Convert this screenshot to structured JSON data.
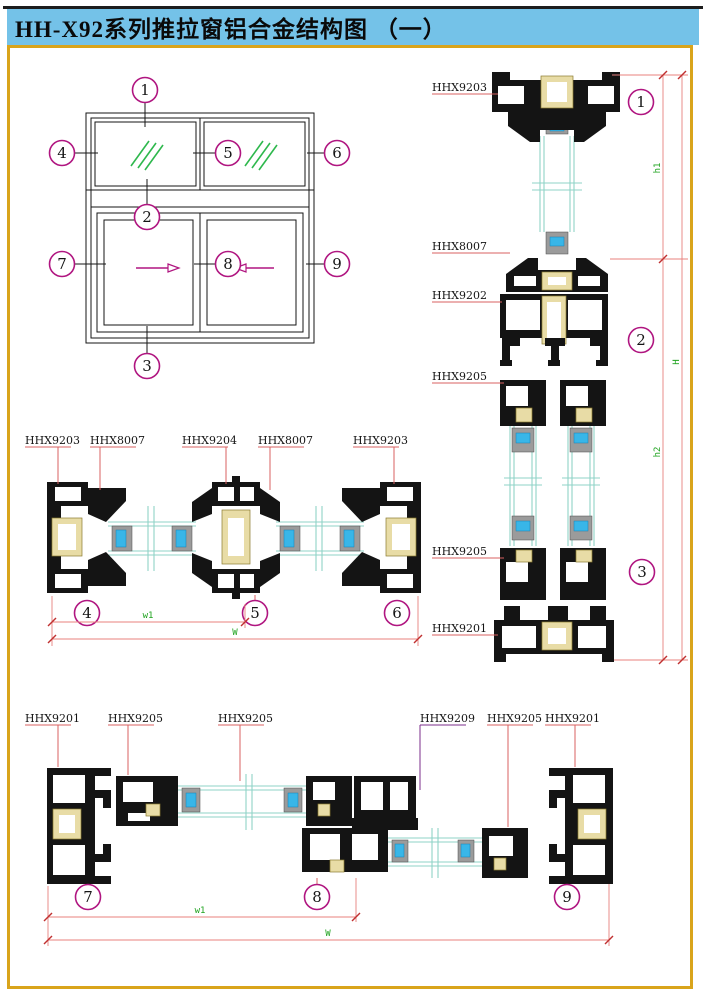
{
  "title": "HH-X92系列推拉窗铝合金结构图 （一）",
  "colors": {
    "title_bg": "#74c2e8",
    "border_gold": "#d9a41b",
    "callout_magenta": "#b01580",
    "leader_red": "#d96060",
    "leader_purple": "#7b2d8b",
    "dim_line_pink": "#e8807e",
    "dim_text_green": "#1fa31f",
    "glass_teal": "#8fd3c7",
    "hatch_green": "#2eb84d",
    "thermal_tan": "#e8dca6",
    "spacer_gray": "#9b9b9b",
    "glazing_blue": "#38b6e8",
    "profile_black": "#141414"
  },
  "schematic": {
    "callouts": [
      "1",
      "2",
      "3",
      "4",
      "5",
      "6",
      "7",
      "8",
      "9"
    ]
  },
  "vertical_section": {
    "labels": [
      "HHX9203",
      "HHX8007",
      "HHX9202",
      "HHX9205",
      "HHX9205",
      "HHX9201"
    ],
    "callouts": [
      "1",
      "2",
      "3"
    ],
    "dims": {
      "inner_top": "h1",
      "overall": "H",
      "inner_bottom": "h2"
    }
  },
  "top_horizontal_section": {
    "labels": [
      "HHX9203",
      "HHX8007",
      "HHX9204",
      "HHX8007",
      "HHX9203"
    ],
    "callouts": [
      "4",
      "5",
      "6"
    ],
    "dims": {
      "inner": "w1",
      "overall": "W"
    }
  },
  "bottom_horizontal_section": {
    "labels": [
      "HHX9201",
      "HHX9205",
      "HHX9205",
      "HHX9209",
      "HHX9205",
      "HHX9201"
    ],
    "callouts": [
      "7",
      "8",
      "9"
    ],
    "dims": {
      "inner": "w1",
      "overall": "W"
    }
  }
}
